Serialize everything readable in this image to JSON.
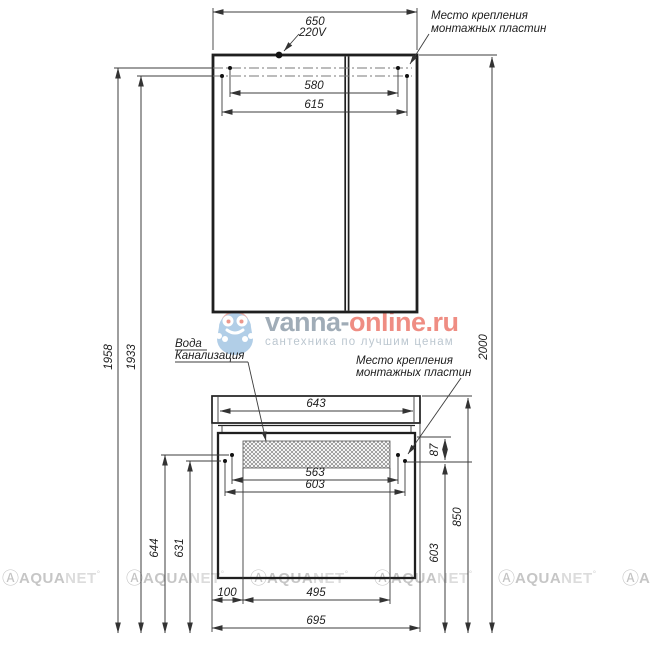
{
  "drawing": {
    "labels": {
      "power": "220V",
      "mount_plate_line1": "Место крепления",
      "mount_plate_line2": "монтажных пластин",
      "water_line1": "Вода",
      "water_line2": "Канализация"
    },
    "dims": {
      "mirror_width": "650",
      "mirror_mount_inner": "580",
      "mirror_mount_outer": "615",
      "height_mount_upper": "1958",
      "height_mount_lower": "1933",
      "height_total": "2000",
      "counter_inner": "643",
      "base_mount_inner": "563",
      "base_mount_outer": "603",
      "plate_drop": "87",
      "counter_height": "850",
      "base_mount_height": "603",
      "base_mount_upper_height": "644",
      "base_mount_lower_height": "631",
      "drain_offset": "100",
      "drain_span": "495",
      "base_width": "695"
    }
  },
  "watermarks": {
    "center": {
      "brand_prefix": "vanna-",
      "brand_suffix": "online.ru",
      "tagline": "сантехника по лучшим ценам",
      "brand_gray_color": "#96a4b0",
      "brand_red_color": "#ee8176",
      "mascot_pink": "#f2a79e",
      "mascot_blue": "#a9c9e5"
    },
    "tile": {
      "logo_glyph": "Ⓐ",
      "brand_bold": "AQUA",
      "brand_light": "NET",
      "mark": "°",
      "color": "#cccccc"
    }
  }
}
